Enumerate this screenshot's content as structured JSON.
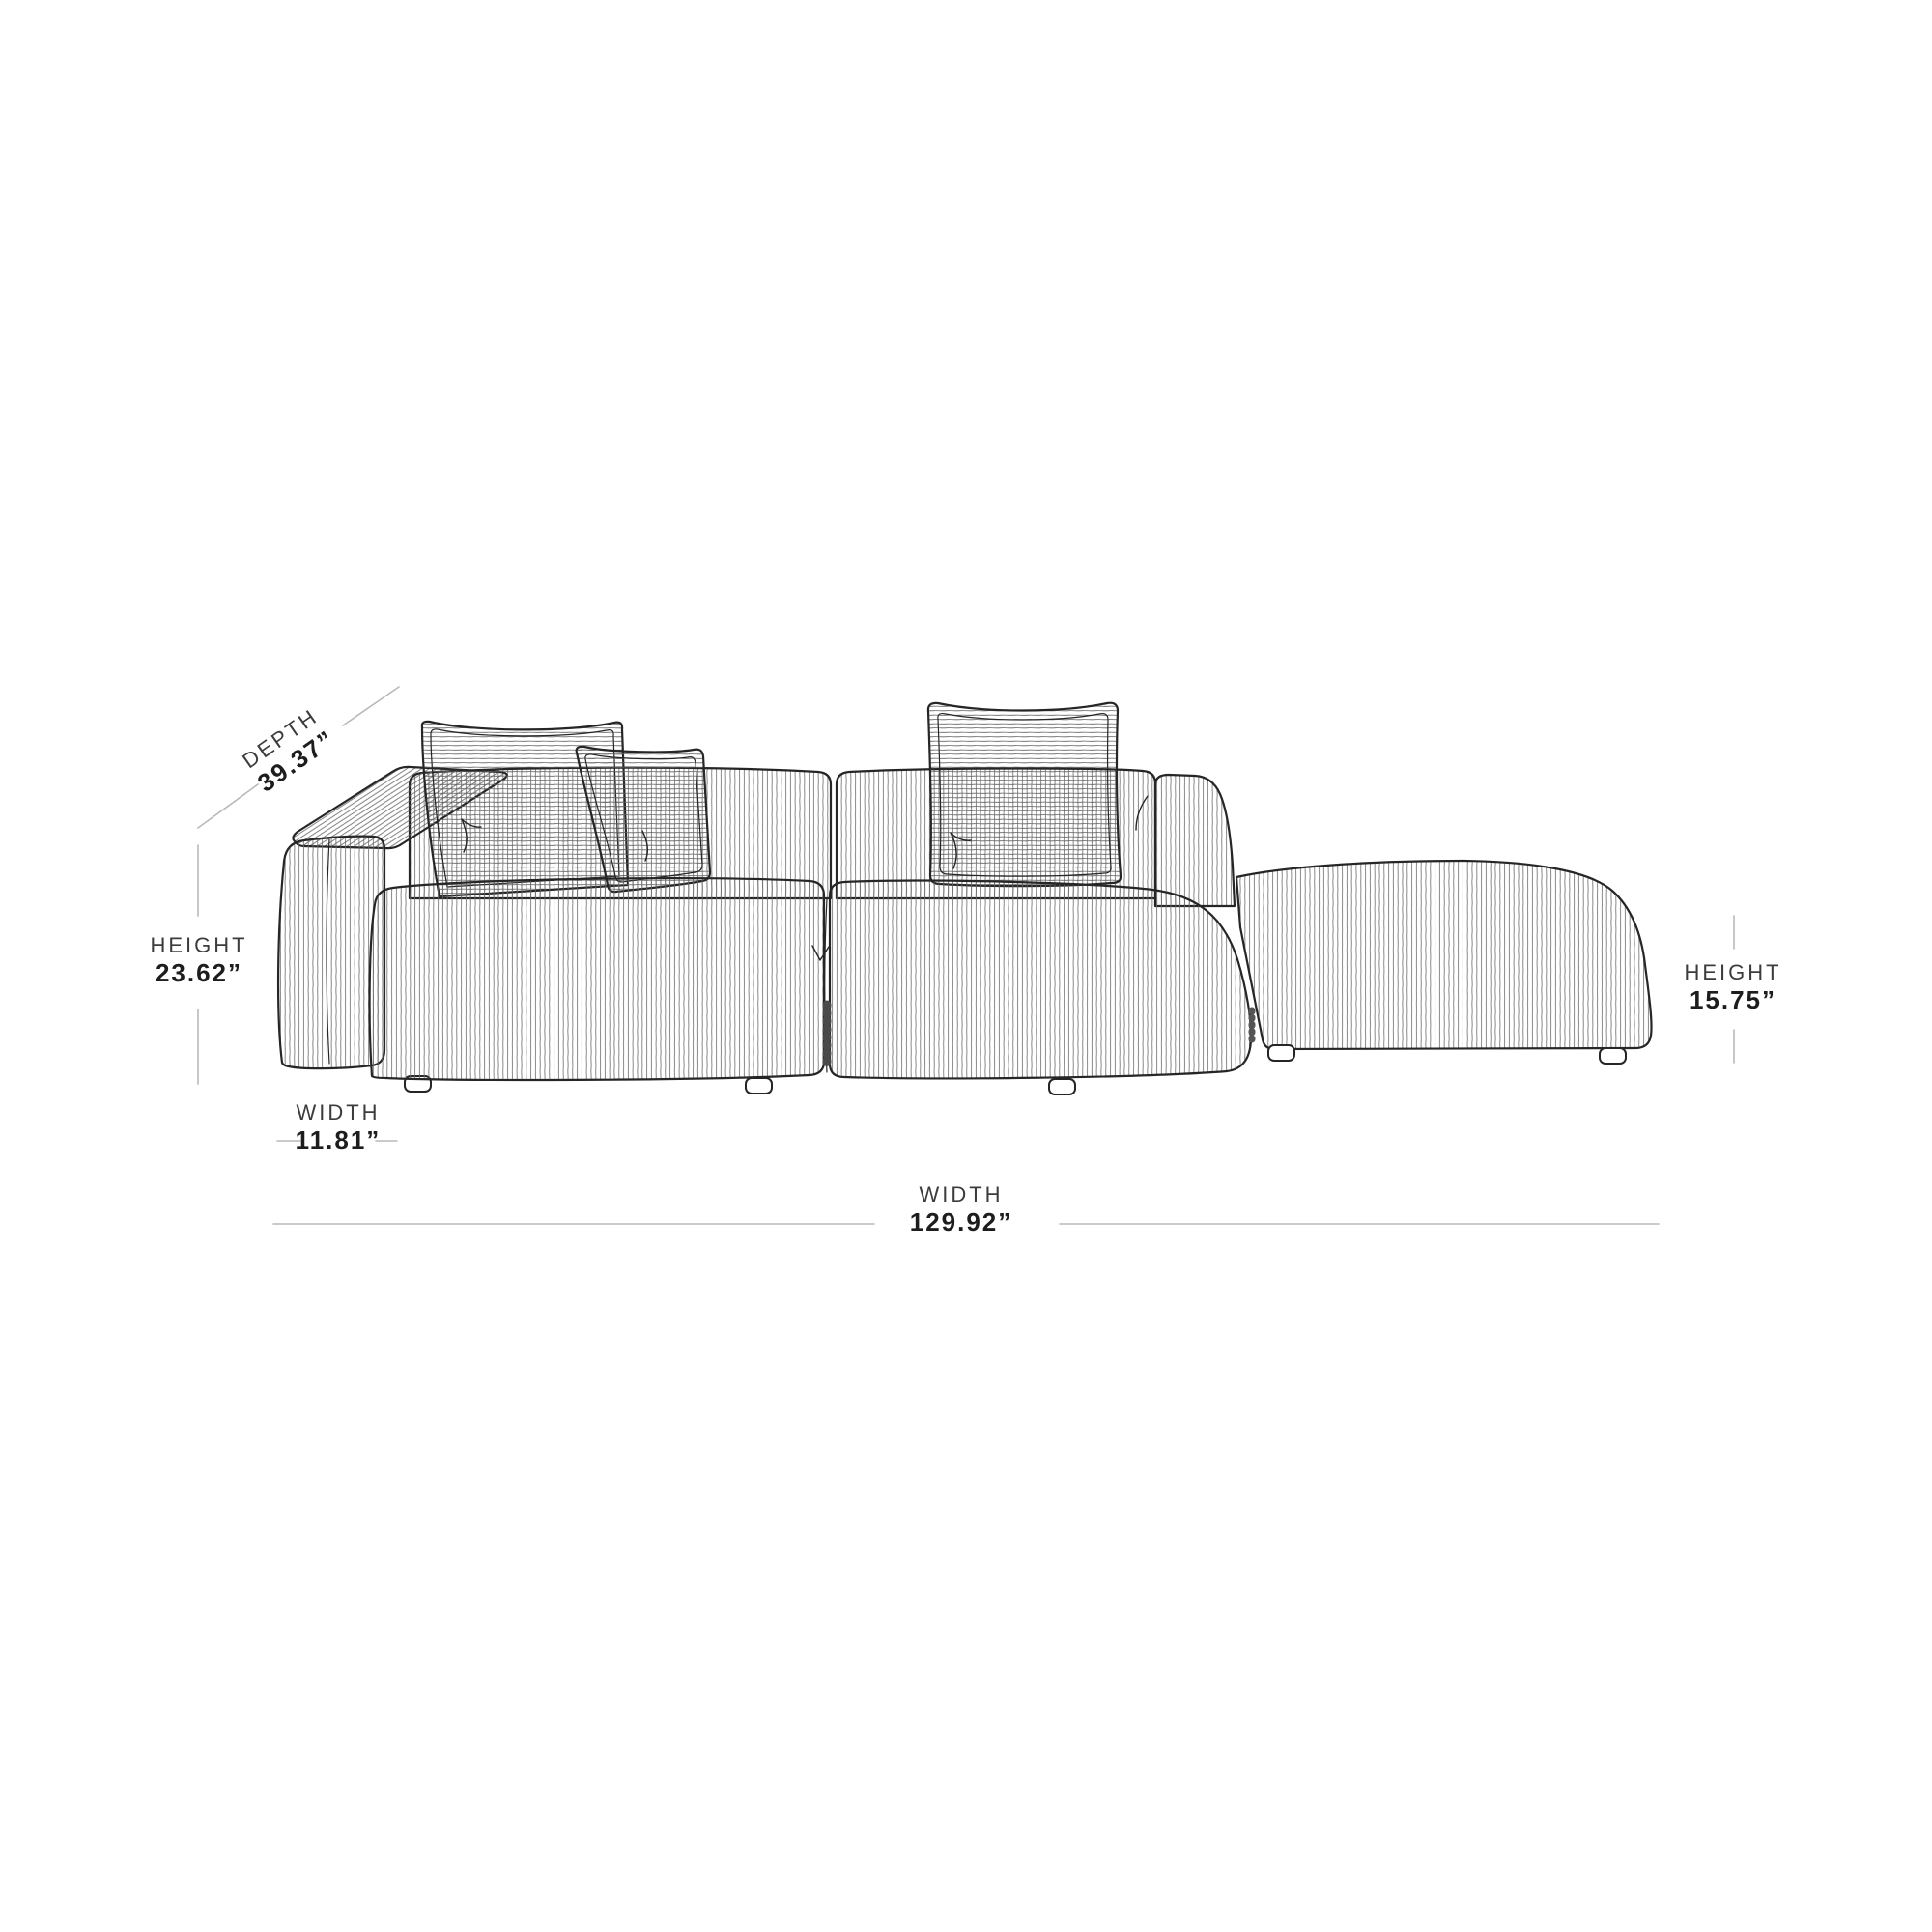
{
  "page": {
    "title": "Sofa dimension diagram",
    "background": "#ffffff"
  },
  "figure": {
    "type": "modular corduroy sofa with chaise ottoman — technical line drawing",
    "parts": [
      "left-arm",
      "left-backrest",
      "right-backrest",
      "right-side-panel",
      "large-left-pillow",
      "small-left-pillow",
      "right-pillow",
      "left-seat-cushion",
      "right-seat-cushion",
      "ottoman",
      "feet"
    ],
    "colors": {
      "background": "#ffffff",
      "outline": "#262626",
      "rib_line": "#6b6b6b",
      "dimension_line": "#b9b9b9",
      "label_text": "#3c3c3c",
      "value_text": "#1d1d1d"
    }
  },
  "dimensions": {
    "depth": {
      "label": "DEPTH",
      "value": "39.37”"
    },
    "height_back": {
      "label": "HEIGHT",
      "value": "23.62”"
    },
    "width_arm": {
      "label": "WIDTH",
      "value": "11.81”"
    },
    "width_total": {
      "label": "WIDTH",
      "value": "129.92”"
    },
    "height_ottoman": {
      "label": "HEIGHT",
      "value": "15.75”"
    }
  }
}
